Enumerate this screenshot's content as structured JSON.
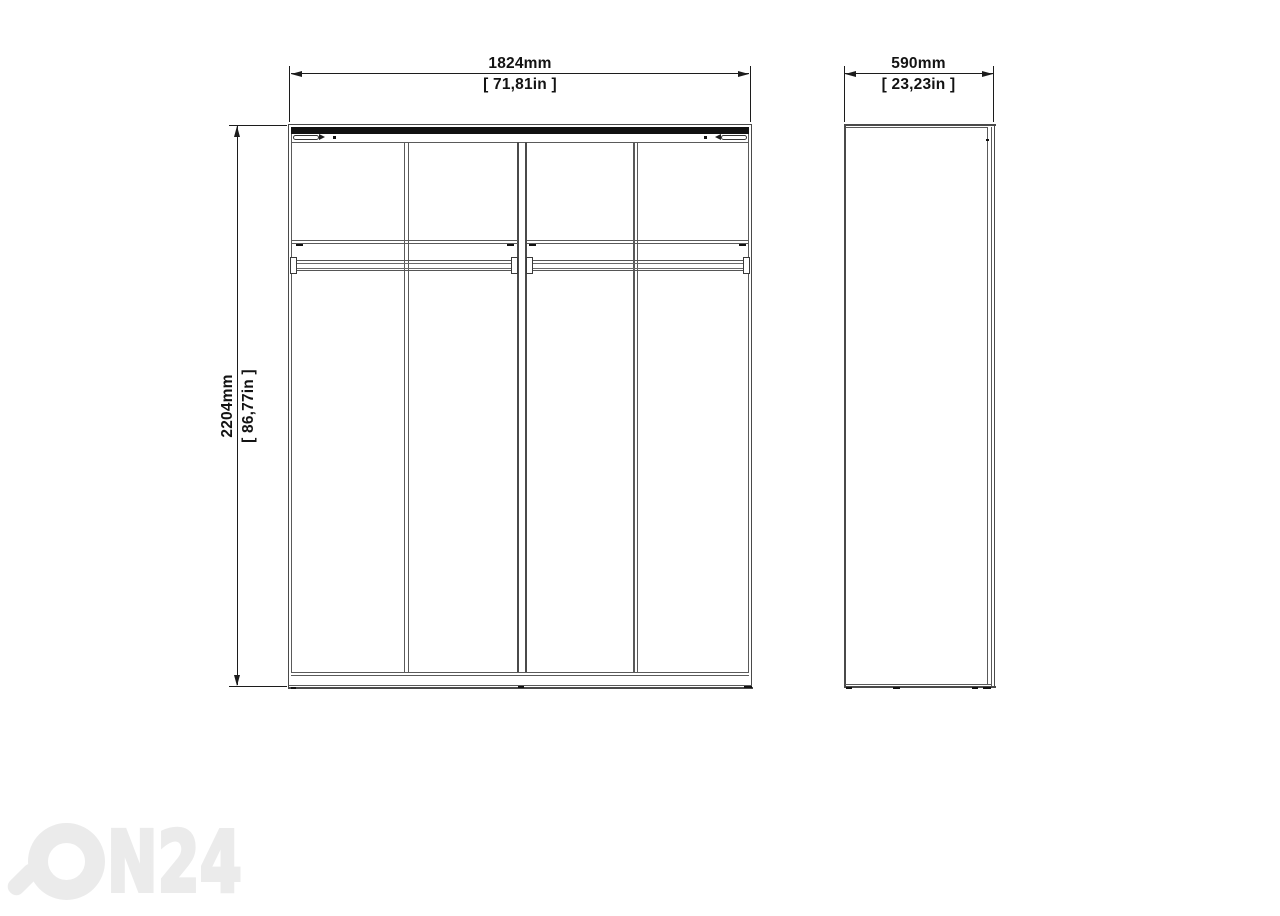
{
  "front": {
    "width_mm": "1824mm",
    "width_in": "[ 71,81in ]",
    "height_mm": "2204mm",
    "height_in": "[ 86,77in ]"
  },
  "side": {
    "depth_mm": "590mm",
    "depth_in": "[ 23,23in ]"
  },
  "watermark": {
    "brand": "ON24",
    "text": "N24"
  },
  "colors": {
    "background": "#ffffff",
    "structure_line": "#4a4a4a",
    "top_track_bar": "#0f0f0f",
    "dimension": "#1c1c1c",
    "watermark": "#ebebeb"
  }
}
